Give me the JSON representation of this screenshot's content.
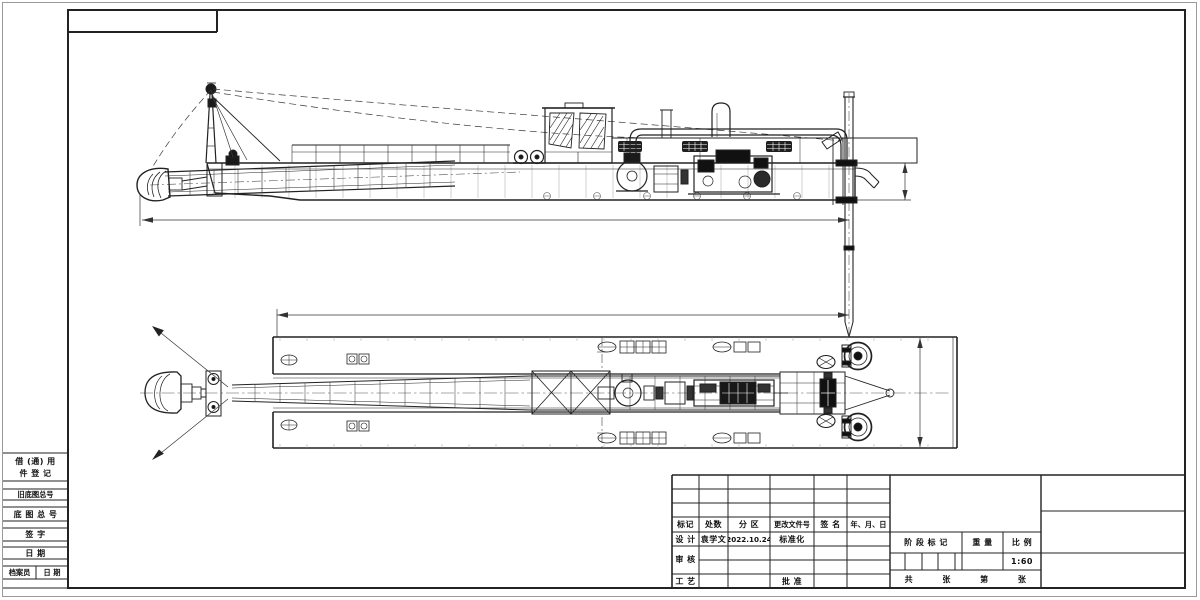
{
  "sheet": {
    "kind": "engineering-drawing",
    "subject": "cutter-suction-dredger general arrangement, side elevation and plan view",
    "background": "#ffffff",
    "line_color": "#222222"
  },
  "revision_table": {
    "headers": [
      "标记",
      "处数",
      "分 区",
      "更改文件号",
      "签 名",
      "年、月、日"
    ]
  },
  "title_block": {
    "design_label": "设 计",
    "designer": "袁学文",
    "design_date": "2022.10.24",
    "standardization_label": "标准化",
    "check_label": "审 核",
    "process_label": "工 艺",
    "approve_label": "批 准",
    "stage_mark_label": "阶 段 标 记",
    "weight_label": "重 量",
    "scale_label": "比 例",
    "scale_value": "1:60",
    "total_label": "共",
    "total_unit": "张",
    "page_label": "第",
    "page_unit": "张"
  },
  "margin_blocks": {
    "borrow_line1": "借 (通) 用",
    "borrow_line2": "件 登 记",
    "old_base_drawing_no": "旧底图总号",
    "base_drawing_no": "底 图 总 号",
    "signature": "签  字",
    "date": "日  期",
    "archivist": "档案员",
    "archivist_date": "日 期"
  }
}
